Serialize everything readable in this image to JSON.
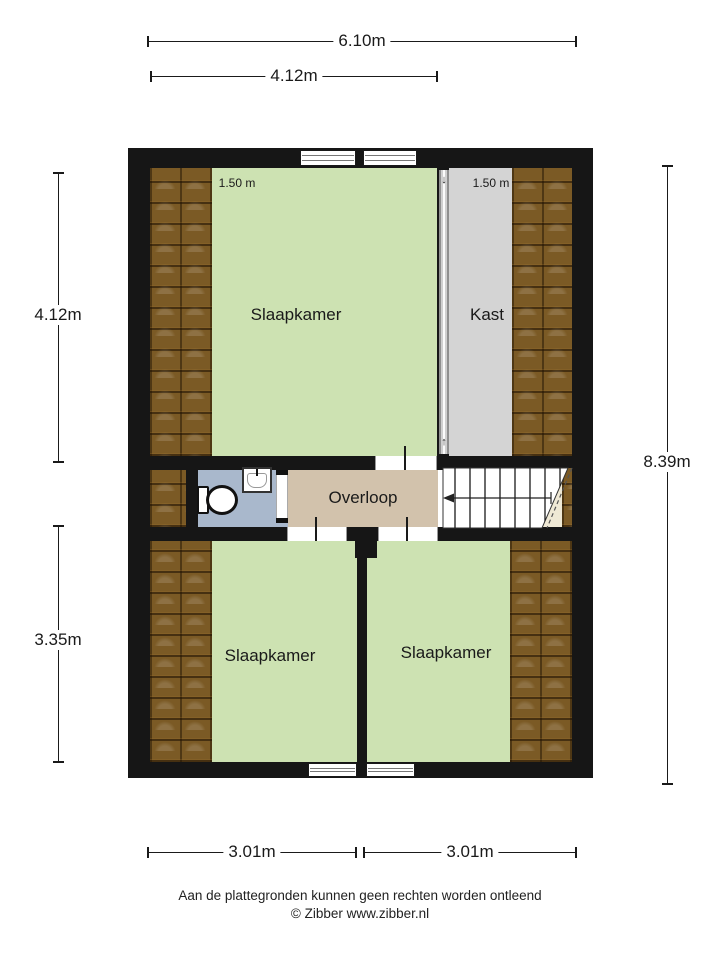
{
  "dims": {
    "width_total": "6.10m",
    "width_top_room": "4.12m",
    "height_top_left": "4.12m",
    "height_bottom_left": "3.35m",
    "height_total": "8.39m",
    "width_bottom_left": "3.01m",
    "width_bottom_right": "3.01m"
  },
  "rooms": {
    "bedroom_top": "Slaapkamer",
    "closet": "Kast",
    "landing": "Overloop",
    "bedroom_bottom_left": "Slaapkamer",
    "bedroom_bottom_right": "Slaapkamer",
    "headroom_left": "1.50 m",
    "headroom_right": "1.50 m"
  },
  "icons": {
    "slide_down": "↓",
    "slide_up": "↑"
  },
  "footer": {
    "disclaimer": "Aan de plattegronden kunnen geen rechten worden ontleend",
    "copyright": "© Zibber www.zibber.nl"
  },
  "colors": {
    "floor_green": "#cde2b2",
    "floor_tan": "#d2c2ac",
    "floor_blue": "#a9b8cc",
    "floor_gray": "#d4d4d4",
    "wall_black": "#161616"
  }
}
